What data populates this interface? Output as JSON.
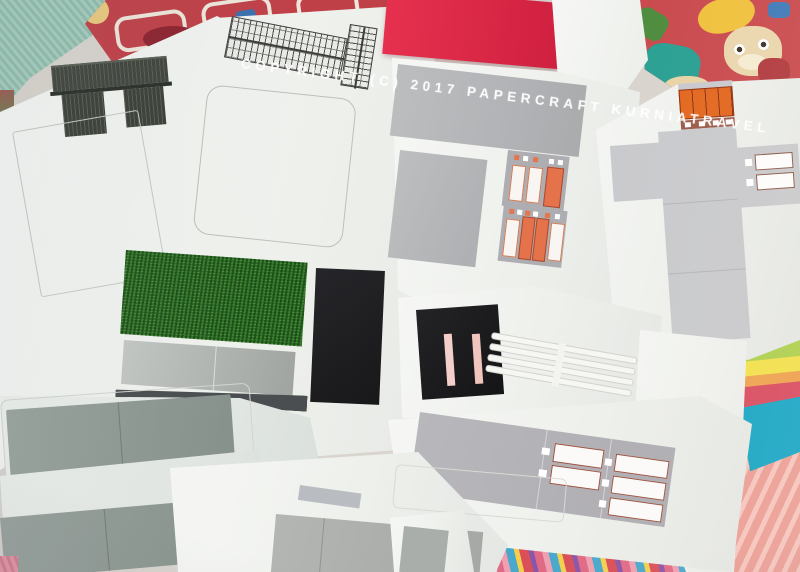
{
  "scene": {
    "type": "photograph",
    "description": "Overlapping printed papercraft template sheets for a model train-station kit, photographed lying on a colorful children's play mat",
    "watermark": {
      "text": "COPYRIGHT (C) 2017 PAPERCRAFT KURNIATRAVEL"
    }
  },
  "palette": {
    "paper_white": "#f3f4f2",
    "piece_gray": "#b5b6b9",
    "sage_gray": "#98a19b",
    "red_sheet": "#e02c4a",
    "orange_door": "#e4724a",
    "orange_shutter": "#e2671f",
    "grass_green": "#2c6f26",
    "black_piece": "#1d1d1f",
    "gate_dark": "#3c4138",
    "slot_pink": "#f2cfc8",
    "mat_teal": "#9cc5b6",
    "mat_red": "#c04048",
    "mat_cyan": "#18a6c5",
    "mat_salmon": "#eb9e95",
    "mat_crimson": "#d84b60"
  },
  "pieces": [
    {
      "id": "gate",
      "label": "dark station gate with columns"
    },
    {
      "id": "track-grid",
      "label": "cross-hatched grid strips"
    },
    {
      "id": "platform-outline",
      "label": "faint fold outline rectangle"
    },
    {
      "id": "grass-mat",
      "label": "grass texture base piece"
    },
    {
      "id": "black-column",
      "label": "black column wrap piece"
    },
    {
      "id": "red-sheet",
      "label": "red card sheet"
    },
    {
      "id": "wall-panels",
      "label": "large gray wall panels"
    },
    {
      "id": "door-strips",
      "label": "strips with orange and white doors"
    },
    {
      "id": "kiosk-cross",
      "label": "cross-shaped unfold with orange shutter"
    },
    {
      "id": "black-doorway",
      "label": "black doorway with pink slots"
    },
    {
      "id": "track-outlines",
      "label": "blank outlined track strips"
    },
    {
      "id": "window-strip",
      "label": "gray strip with window frames"
    },
    {
      "id": "base-panels",
      "label": "large gray base panels with glue tabs"
    }
  ]
}
